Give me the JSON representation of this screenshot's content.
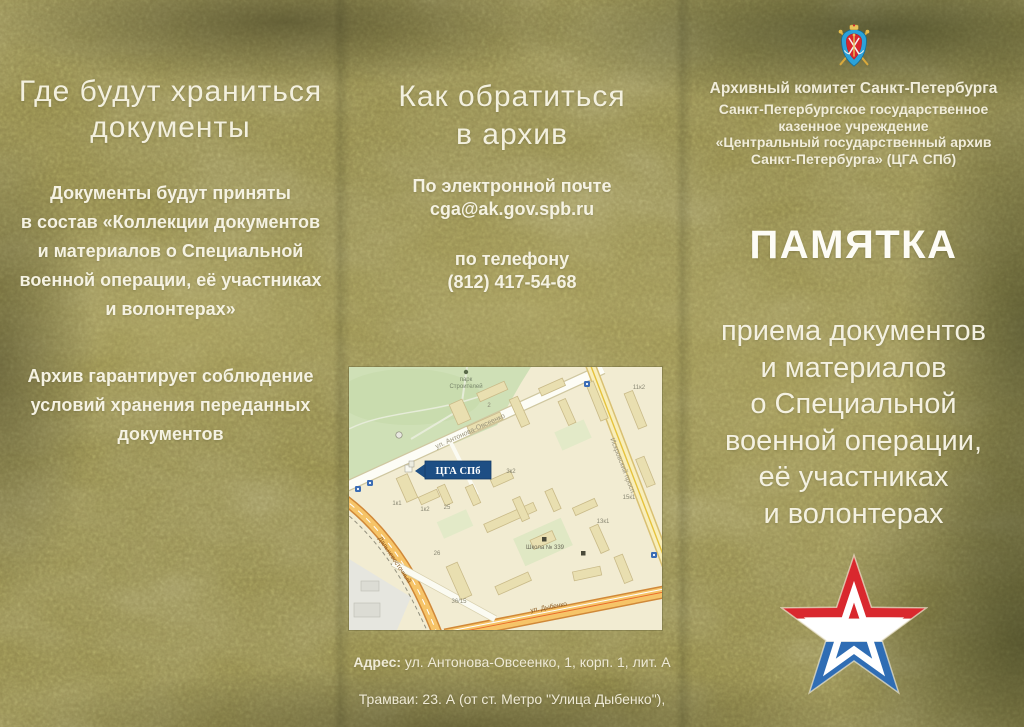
{
  "left_panel": {
    "heading": "Где будут храниться\nдокументы",
    "para1": "Документы будут приняты\nв состав «Коллекции документов\nи материалов о Специальной\nвоенной операции, её участниках\nи волонтерах»",
    "para2": "Архив гарантирует соблюдение\nусловий хранения переданных\nдокументов"
  },
  "middle_panel": {
    "heading": "Как обратиться\nв архив",
    "email_block": "По электронной почте\ncga@ak.gov.spb.ru",
    "phone_block": "по телефону\n(812) 417-54-68",
    "address_label": "Адрес:",
    "address_rest": " ул. Антонова-Овсеенко, 1, корп. 1, лит. А",
    "address_line2": "Трамваи: 23. А (от ст. Метро \"Улица Дыбенко\"),",
    "address_line3": "27 (от ст. Метро \"Проспект Большевиков\")"
  },
  "right_panel": {
    "org_line1": "Архивный комитет Санкт-Петербурга",
    "org_rest": "Санкт-Петербургское государственное\nказенное учреждение\n«Центральный государственный архив\nСанкт-Петербурга» (ЦГА СПб)",
    "title": "ПАМЯТКА",
    "subtitle": "приема документов\nи материалов\nо Специальной\nвоенной операции,\nеё участниках\nи волонтерах"
  },
  "map": {
    "marker_label": "ЦГА СПб",
    "park_label_line1": "парк",
    "park_label_line2": "Строителей",
    "school_label": "Школа № 339",
    "streets": {
      "antonova": "ул. Антонова-Овсеенко",
      "dybenko": "ул. Дыбенко",
      "dalnevostochny": "Дальневосточный",
      "iskrovsky": "Искровский просп."
    },
    "buildings": [
      "1к1",
      "1к2",
      "25",
      "2",
      "3к2",
      "26",
      "36/15",
      "13к1",
      "11к2",
      "15к1"
    ]
  },
  "colors": {
    "background_olive": "#8e8549",
    "text_cream": "#f3f0de",
    "marker_blue": "#1d4e84",
    "star_red": "#d9282e",
    "star_blue": "#2f6db4",
    "emblem_blue": "#2ba2da",
    "emblem_red": "#d7272d",
    "emblem_gold": "#e0b23c",
    "map_cream": "#f2ecd2",
    "map_park_green": "#cfe0b6",
    "map_road_orange": "#f6c468"
  }
}
